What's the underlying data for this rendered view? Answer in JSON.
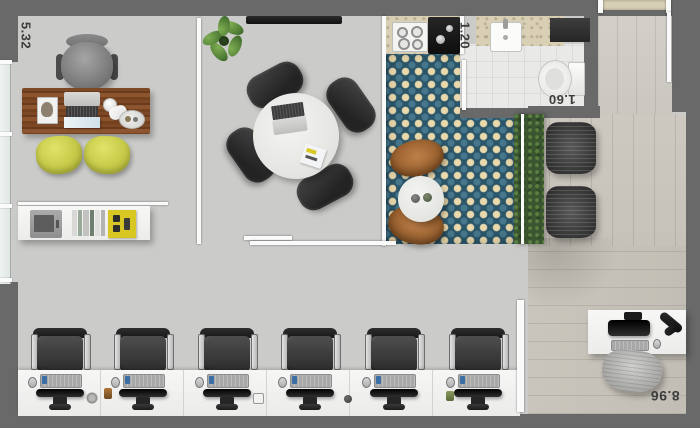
{
  "plan": {
    "type": "office-floor-plan-top-view",
    "dimension_labels": {
      "reception_width": "5.32",
      "bathroom_width": "1.20",
      "bathroom_depth": "1.60",
      "open_office_width": "8.96"
    },
    "workstations": {
      "count": 6
    },
    "meeting_seats": {
      "count": 4
    },
    "lounge_benches": {
      "count": 2
    },
    "palette": {
      "wall_gray": "#696969",
      "concrete_floor": "#cbcbc9",
      "wood_floor": "#c6c2b9",
      "tile_navy": "#2b5569",
      "tile_cream": "#ead9ad",
      "desk_wood_brown": "#7d4826",
      "guest_chair_yellow": "#c6ca48",
      "hedge_green": "#3c5531",
      "furniture_white": "#f4f4f3",
      "seat_dark": "#333333"
    }
  }
}
